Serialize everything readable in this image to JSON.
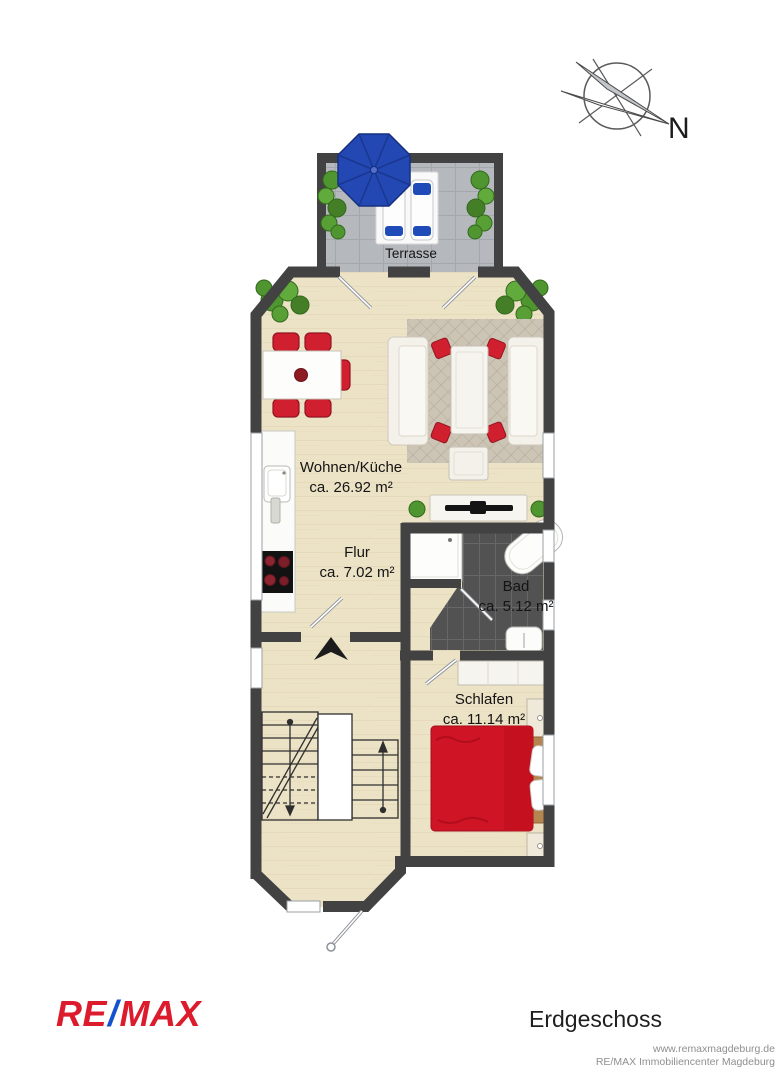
{
  "compass": {
    "label": "N"
  },
  "plan": {
    "terrace": {
      "label": "Terrasse"
    },
    "rooms": {
      "living": {
        "label": "Wohnen/Küche",
        "area": "ca. 26.92 m²"
      },
      "hall": {
        "label": "Flur",
        "area": "ca. 7.02 m²"
      },
      "bath": {
        "label": "Bad",
        "area": "ca. 5.12 m²"
      },
      "bedroom": {
        "label": "Schlafen",
        "area": "ca. 11.14 m²"
      }
    }
  },
  "footer": {
    "logo_re": "RE",
    "logo_slash": "/",
    "logo_max": "MAX",
    "floor_label": "Erdgeschoss",
    "website": "www.remaxmagdeburg.de",
    "company": "RE/MAX Immobiliencenter Magdeburg"
  },
  "colors": {
    "wall": "#424242",
    "floor": "#ece2c6",
    "terrace_tile": "#b5b9be",
    "bath_tile": "#525252",
    "accent_red": "#d01f2f",
    "bed_red": "#cf1426",
    "umbrella_blue": "#2348b4",
    "plant_green": "#4f9630",
    "rug": "#ccc4b5",
    "logo_red": "#dc1c2c",
    "logo_blue": "#1552d0",
    "footer_gray": "#8f8f8f"
  }
}
